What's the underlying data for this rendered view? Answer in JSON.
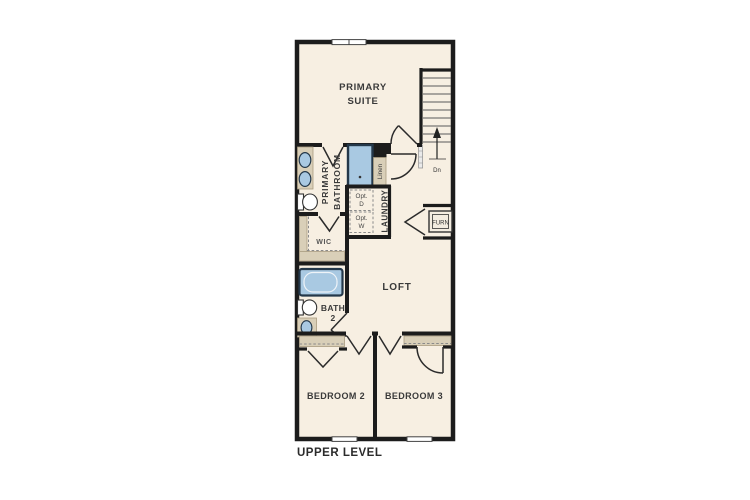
{
  "caption": "UPPER LEVEL",
  "colors": {
    "floor": "#f7efe2",
    "wall": "#1c1c1c",
    "fixture_blue": "#a9c9e2",
    "fixture_blue_border": "#24384a",
    "counter_tan": "#d9cfb8",
    "text_dark": "#3a3a3a"
  },
  "rooms": {
    "primary_suite": {
      "line1": "PRIMARY",
      "line2": "SUITE"
    },
    "primary_bathroom": {
      "line1": "PRIMARY",
      "line2": "BATHROOM"
    },
    "wic": {
      "label": "WIC"
    },
    "linen": {
      "label": "Linen"
    },
    "laundry": {
      "label": "LAUNDRY"
    },
    "loft": {
      "label": "LOFT"
    },
    "bath2": {
      "line1": "BATH",
      "line2": "2"
    },
    "bedroom2": {
      "label": "BEDROOM 2"
    },
    "bedroom3": {
      "label": "BEDROOM 3"
    }
  },
  "features": {
    "furnace": {
      "label": "FURN"
    },
    "stairs": {
      "direction_label": "Dn"
    },
    "optional_dryer": {
      "line1": "Opt.",
      "line2": "D"
    },
    "optional_washer": {
      "line1": "Opt.",
      "line2": "W"
    }
  }
}
